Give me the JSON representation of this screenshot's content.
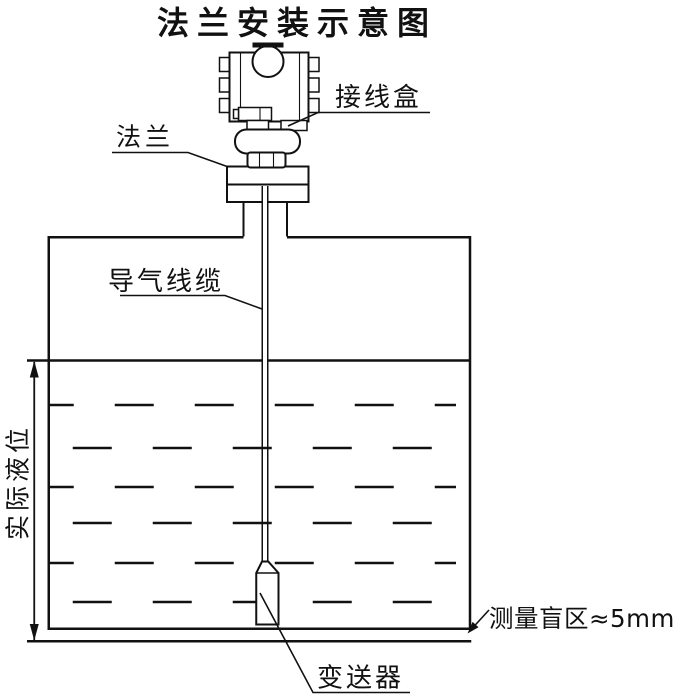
{
  "title": "法兰安装示意图",
  "diagram": {
    "labels": {
      "junction_box": "接线盒",
      "flange": "法兰",
      "air_cable": "导气线缆",
      "actual_level": "实际液位",
      "transmitter": "变送器",
      "blind_zone": "测量盲区≈5mm"
    },
    "colors": {
      "line": "#111111",
      "background": "#ffffff"
    }
  }
}
